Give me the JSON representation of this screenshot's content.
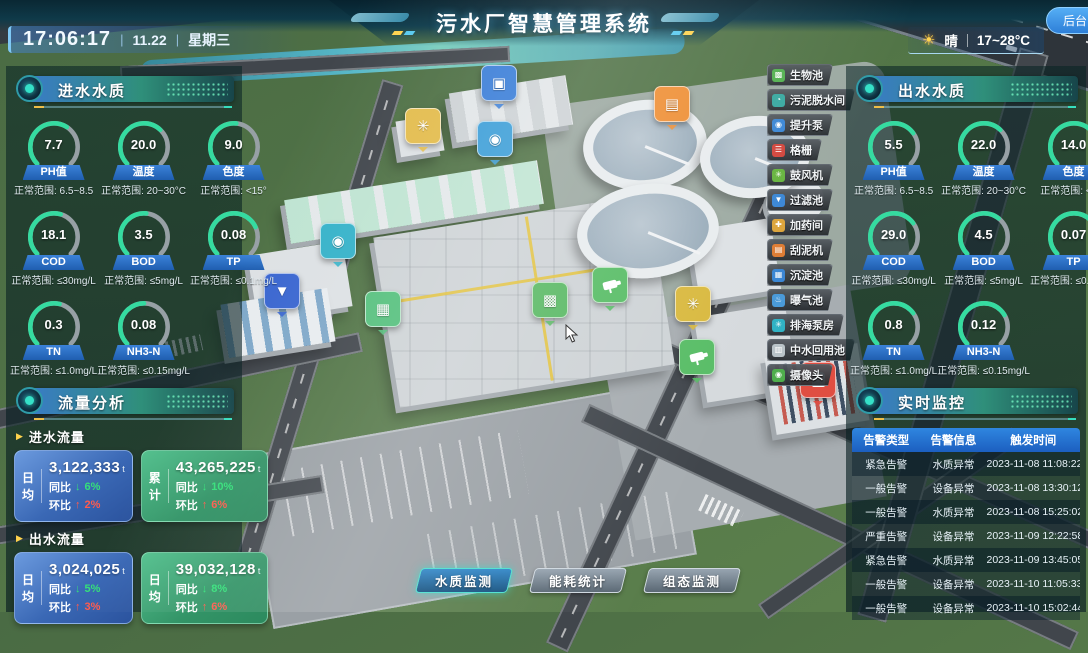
{
  "header": {
    "title": "污水厂智慧管理系统",
    "time": "17:06:17",
    "date": "11.22",
    "weekday": "星期三",
    "separator": "|",
    "weather_condition": "晴",
    "weather_temp": "17~28°C",
    "backend_label": "后台"
  },
  "inlet_panel": {
    "title": "进水水质",
    "gauges": [
      {
        "label": "PH值",
        "value": "7.7",
        "range": "正常范围: 6.5~8.5",
        "color": "#35dba0",
        "pct": 62
      },
      {
        "label": "温度",
        "value": "20.0",
        "range": "正常范围: 20~30°C",
        "color": "#35dba0",
        "pct": 66
      },
      {
        "label": "色度",
        "value": "9.0",
        "range": "正常范围: <15°",
        "color": "#e9c25c",
        "pct": 52
      },
      {
        "label": "COD",
        "value": "18.1",
        "range": "正常范围: ≤30mg/L",
        "color": "#35dba0",
        "pct": 56
      },
      {
        "label": "BOD",
        "value": "3.5",
        "range": "正常范围: ≤5mg/L",
        "color": "#35dba0",
        "pct": 52
      },
      {
        "label": "TP",
        "value": "0.08",
        "range": "正常范围: ≤0.1mg/L",
        "color": "#35dba0",
        "pct": 74
      },
      {
        "label": "TN",
        "value": "0.3",
        "range": "正常范围: ≤1.0mg/L",
        "color": "#35dba0",
        "pct": 55
      },
      {
        "label": "NH3-N",
        "value": "0.08",
        "range": "正常范围: ≤0.15mg/L",
        "color": "#e9c25c",
        "pct": 50
      }
    ]
  },
  "flow_panel": {
    "title": "流量分析",
    "sections": [
      {
        "label": "进水流量",
        "cards": [
          {
            "metric": "日均",
            "value": "3,122,333",
            "unit": "t",
            "yoy_label": "同比",
            "yoy_arrow": "↓",
            "yoy": "6%",
            "mom_label": "环比",
            "mom_arrow": "↑",
            "mom": "2%"
          },
          {
            "metric": "累计",
            "value": "43,265,225",
            "unit": "t",
            "yoy_label": "同比",
            "yoy_arrow": "↓",
            "yoy": "10%",
            "mom_label": "环比",
            "mom_arrow": "↑",
            "mom": "6%"
          }
        ]
      },
      {
        "label": "出水流量",
        "cards": [
          {
            "metric": "日均",
            "value": "3,024,025",
            "unit": "t",
            "yoy_label": "同比",
            "yoy_arrow": "↓",
            "yoy": "5%",
            "mom_label": "环比",
            "mom_arrow": "↑",
            "mom": "3%"
          },
          {
            "metric": "日均",
            "value": "39,032,128",
            "unit": "t",
            "yoy_label": "同比",
            "yoy_arrow": "↓",
            "yoy": "8%",
            "mom_label": "环比",
            "mom_arrow": "↑",
            "mom": "6%"
          }
        ]
      }
    ]
  },
  "outlet_panel": {
    "title": "出水水质",
    "gauges": [
      {
        "label": "PH值",
        "value": "5.5",
        "range": "正常范围: 6.5~8.5",
        "color": "#35dba0",
        "pct": 70
      },
      {
        "label": "温度",
        "value": "22.0",
        "range": "正常范围: 20~30°C",
        "color": "#35dba0",
        "pct": 66
      },
      {
        "label": "色度",
        "value": "14.0",
        "range": "正常范围: <15°",
        "color": "#e9c25c",
        "pct": 76
      },
      {
        "label": "COD",
        "value": "29.0",
        "range": "正常范围: ≤30mg/L",
        "color": "#35dba0",
        "pct": 70
      },
      {
        "label": "BOD",
        "value": "4.5",
        "range": "正常范围: ≤5mg/L",
        "color": "#35dba0",
        "pct": 64
      },
      {
        "label": "TP",
        "value": "0.07",
        "range": "正常范围: ≤0.1mg/L",
        "color": "#35dba0",
        "pct": 72
      },
      {
        "label": "TN",
        "value": "0.8",
        "range": "正常范围: ≤1.0mg/L",
        "color": "#35dba0",
        "pct": 70
      },
      {
        "label": "NH3-N",
        "value": "0.12",
        "range": "正常范围: ≤0.15mg/L",
        "color": "#e9c25c",
        "pct": 72
      }
    ]
  },
  "monitor_panel": {
    "title": "实时监控",
    "table": {
      "headers": [
        "告警类型",
        "告警信息",
        "触发时间"
      ],
      "rows": [
        [
          "紧急告警",
          "水质异常",
          "2023-11-08 11:08:22"
        ],
        [
          "一般告警",
          "设备异常",
          "2023-11-08 13:30:12"
        ],
        [
          "一般告警",
          "水质异常",
          "2023-11-08 15:25:02"
        ],
        [
          "严重告警",
          "设备异常",
          "2023-11-09 12:22:58"
        ],
        [
          "紧急告警",
          "水质异常",
          "2023-11-09 13:45:05"
        ],
        [
          "一般告警",
          "设备异常",
          "2023-11-10 11:05:33"
        ],
        [
          "一般告警",
          "设备异常",
          "2023-11-10 15:02:44"
        ]
      ]
    }
  },
  "facility_list": {
    "items": [
      {
        "label": "生物池",
        "icon": "bio-pool-icon",
        "glyph": "▩",
        "color": "#52b04f"
      },
      {
        "label": "污泥脱水间",
        "icon": "sludge-dewater-icon",
        "glyph": "◔",
        "color": "#38a8a0"
      },
      {
        "label": "提升泵",
        "icon": "lift-pump-icon",
        "glyph": "◉",
        "color": "#3a86d4"
      },
      {
        "label": "格栅",
        "icon": "grid-screen-icon",
        "glyph": "☰",
        "color": "#d2453c"
      },
      {
        "label": "鼓风机",
        "icon": "blower-icon",
        "glyph": "✳",
        "color": "#66b43e"
      },
      {
        "label": "过滤池",
        "icon": "filter-pool-icon",
        "glyph": "▼",
        "color": "#3a86d4"
      },
      {
        "label": "加药间",
        "icon": "dosing-room-icon",
        "glyph": "✚",
        "color": "#dca43a"
      },
      {
        "label": "刮泥机",
        "icon": "mud-scraper-icon",
        "glyph": "▤",
        "color": "#de7c33"
      },
      {
        "label": "沉淀池",
        "icon": "sedimentation-pool-icon",
        "glyph": "▦",
        "color": "#3a86d4"
      },
      {
        "label": "曝气池",
        "icon": "aeration-pool-icon",
        "glyph": "♨",
        "color": "#4a9ad8"
      },
      {
        "label": "排海泵房",
        "icon": "sea-pump-house-icon",
        "glyph": "✳",
        "color": "#30b2c4"
      },
      {
        "label": "中水回用池",
        "icon": "water-reuse-pool-icon",
        "glyph": "▥",
        "color": "#b9c3c8"
      },
      {
        "label": "摄像头",
        "icon": "camera-icon",
        "glyph": "◉",
        "color": "#4fae4c"
      }
    ]
  },
  "bottom_tabs": [
    {
      "label": "水质监测",
      "active": true
    },
    {
      "label": "能耗统计",
      "active": false
    },
    {
      "label": "组态监测",
      "active": false
    }
  ],
  "map_markers": [
    {
      "name": "monitor-marker",
      "glyph": "▣",
      "color": "#3c7fd8"
    },
    {
      "name": "scraper-marker",
      "glyph": "▤",
      "color": "#ee8f35"
    },
    {
      "name": "fan-marker",
      "glyph": "✳",
      "color": "#e3bc4d"
    },
    {
      "name": "pump-marker",
      "glyph": "◉",
      "color": "#3e9fd8"
    },
    {
      "name": "pump-marker-2",
      "glyph": "◉",
      "color": "#35b2c9"
    },
    {
      "name": "funnel-marker",
      "glyph": "▼",
      "color": "#3a66d0"
    },
    {
      "name": "reuse-marker",
      "glyph": "▦",
      "color": "#55c07d"
    },
    {
      "name": "bio-marker",
      "glyph": "▩",
      "color": "#5ab964"
    },
    {
      "name": "camera-marker",
      "glyph": "",
      "color": "#58bd66"
    },
    {
      "name": "fan-marker-2",
      "glyph": "✳",
      "color": "#d9b93f"
    },
    {
      "name": "camera-marker-2",
      "glyph": "",
      "color": "#58bd66"
    },
    {
      "name": "alarm-lock-marker",
      "glyph": "",
      "color": "#e04e42"
    }
  ]
}
